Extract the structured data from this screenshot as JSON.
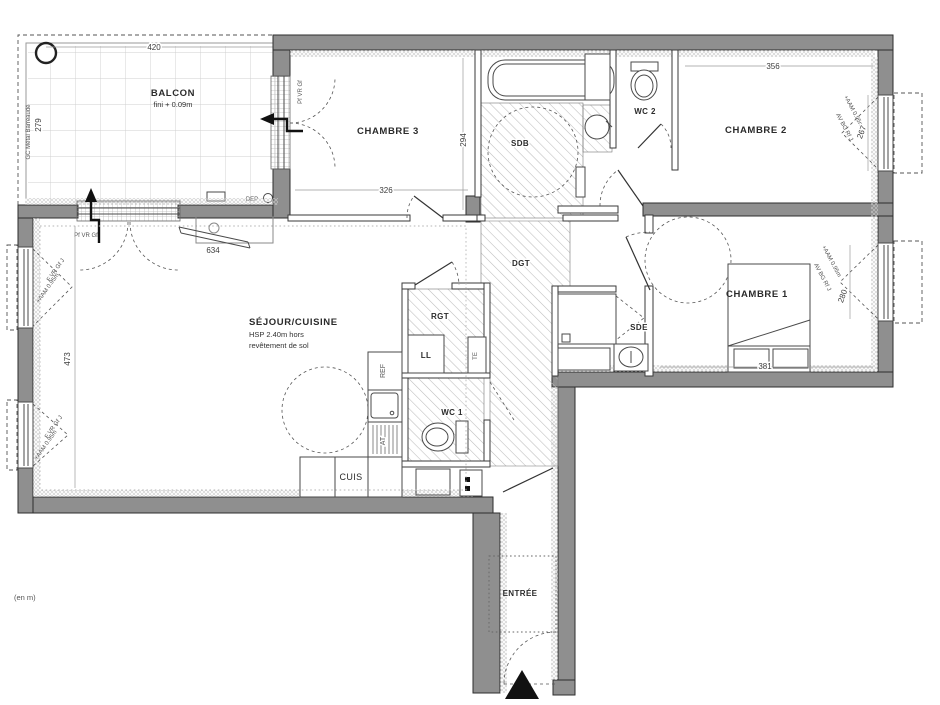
{
  "plan": {
    "units_note": "(en m)",
    "balcony": {
      "label": "BALCON",
      "finish": "fini + 0.09m",
      "dim_width": "420",
      "dim_depth": "279",
      "railing_note": "GC Métal Barreaudé",
      "storage_label": "DEP"
    },
    "bedroom3": {
      "label": "CHAMBRE 3",
      "dim_width": "326",
      "dim_depth": "294",
      "door_label": "Pf VR Gf"
    },
    "bathroom": {
      "label": "SDB"
    },
    "wc2": {
      "label": "WC 2"
    },
    "bedroom2": {
      "label": "CHAMBRE 2",
      "dim_width": "356",
      "dim_window": "267"
    },
    "bedroom1": {
      "label": "CHAMBRE 1",
      "dim_width": "381",
      "dim_window": "280"
    },
    "living": {
      "label": "SÉJOUR/CUISINE",
      "note_line1": "HSP 2.40m hors",
      "note_line2": "revêtement de sol",
      "dim_depth": "473",
      "dim_bay": "634",
      "window_label": "Pf VR Gf"
    },
    "hallway": {
      "label": "DGT"
    },
    "storage": {
      "label": "RGT",
      "washer_label": "LL",
      "panel_label": "TE"
    },
    "wc1": {
      "label": "WC 1"
    },
    "shower_room": {
      "label": "SDE"
    },
    "entry": {
      "label": "ENTRÉE"
    },
    "kitchen": {
      "label": "CUIS",
      "fridge_label": "REF",
      "hob_label": "AT"
    },
    "window_notes": {
      "aam": "+AAM 0.95m",
      "left_type": "F VR Gf J",
      "right_type": "AV BG Rf J"
    }
  }
}
